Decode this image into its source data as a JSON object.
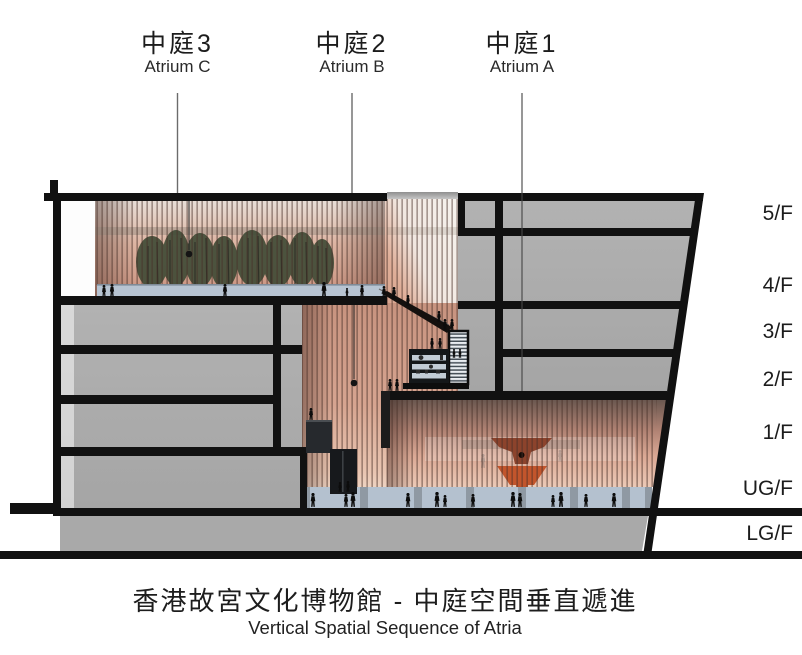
{
  "header": {
    "atria": [
      {
        "zh": "中庭3",
        "en": "Atrium C"
      },
      {
        "zh": "中庭2",
        "en": "Atrium B"
      },
      {
        "zh": "中庭1",
        "en": "Atrium A"
      }
    ]
  },
  "floors": [
    {
      "label": "5/F"
    },
    {
      "label": "4/F"
    },
    {
      "label": "3/F"
    },
    {
      "label": "2/F"
    },
    {
      "label": "1/F"
    },
    {
      "label": "UG/F"
    },
    {
      "label": "LG/F"
    }
  ],
  "footer": {
    "title_zh": "香港故宮文化博物館 - 中庭空間垂直遞進",
    "title_en": "Vertical Spatial Sequence of Atria"
  },
  "colors": {
    "ink": "#111111",
    "poche_gray": "#acacac",
    "slat_warm": "#d3a18d",
    "glass_blue": "#b6c3d1",
    "sculpture_red": "#bf5028",
    "tree_green": "#414c37",
    "louver_gray": "#49525a"
  }
}
